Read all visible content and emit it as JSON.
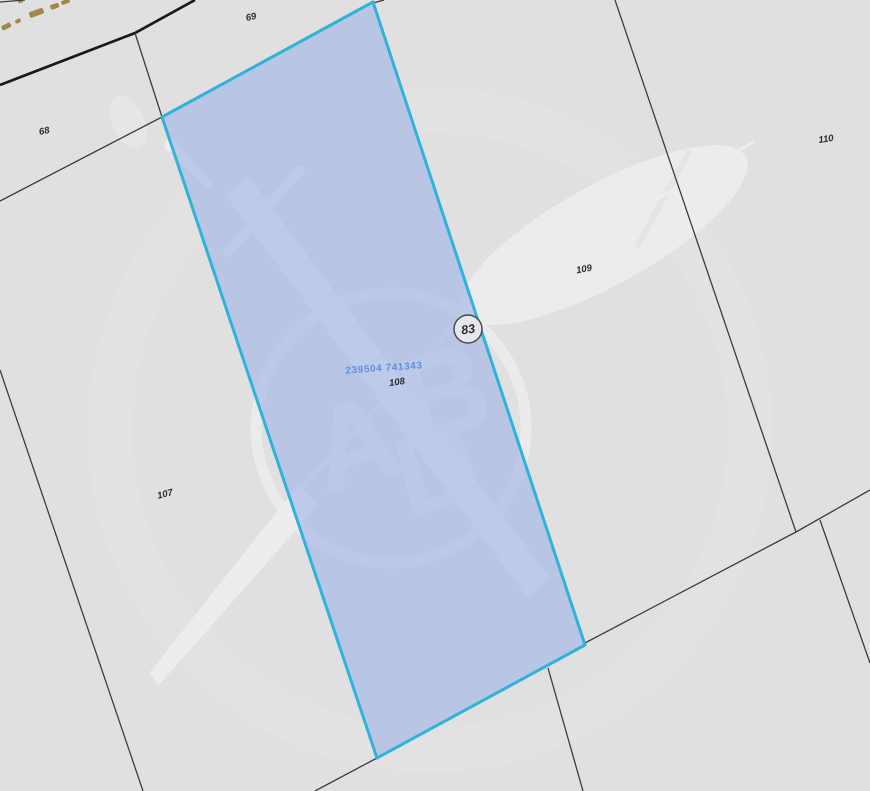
{
  "map": {
    "type": "cadastral-parcel-map",
    "background_color": "#e0e0e0",
    "boundary_color": "#3d3d3d",
    "road_color": "#1a1a1a",
    "track_dash_color": "#a2874a",
    "label_color": "#2e2e2e",
    "selected_parcel": {
      "label": "108",
      "grid_reference": "239504 741343",
      "grid_reference_color": "#6090d8",
      "border_color": "#2fb3d9",
      "fill_color": "#9db3e8"
    },
    "parcel_labels": [
      {
        "id": "69"
      },
      {
        "id": "68"
      },
      {
        "id": "110"
      },
      {
        "id": "109"
      },
      {
        "id": "107"
      }
    ],
    "circled_marker": {
      "label": "83"
    },
    "watermark": {
      "description": "crossed sword and quill feather behind circular monogram",
      "letters": [
        "A",
        "B",
        "D"
      ],
      "color": "#ffffff"
    }
  }
}
